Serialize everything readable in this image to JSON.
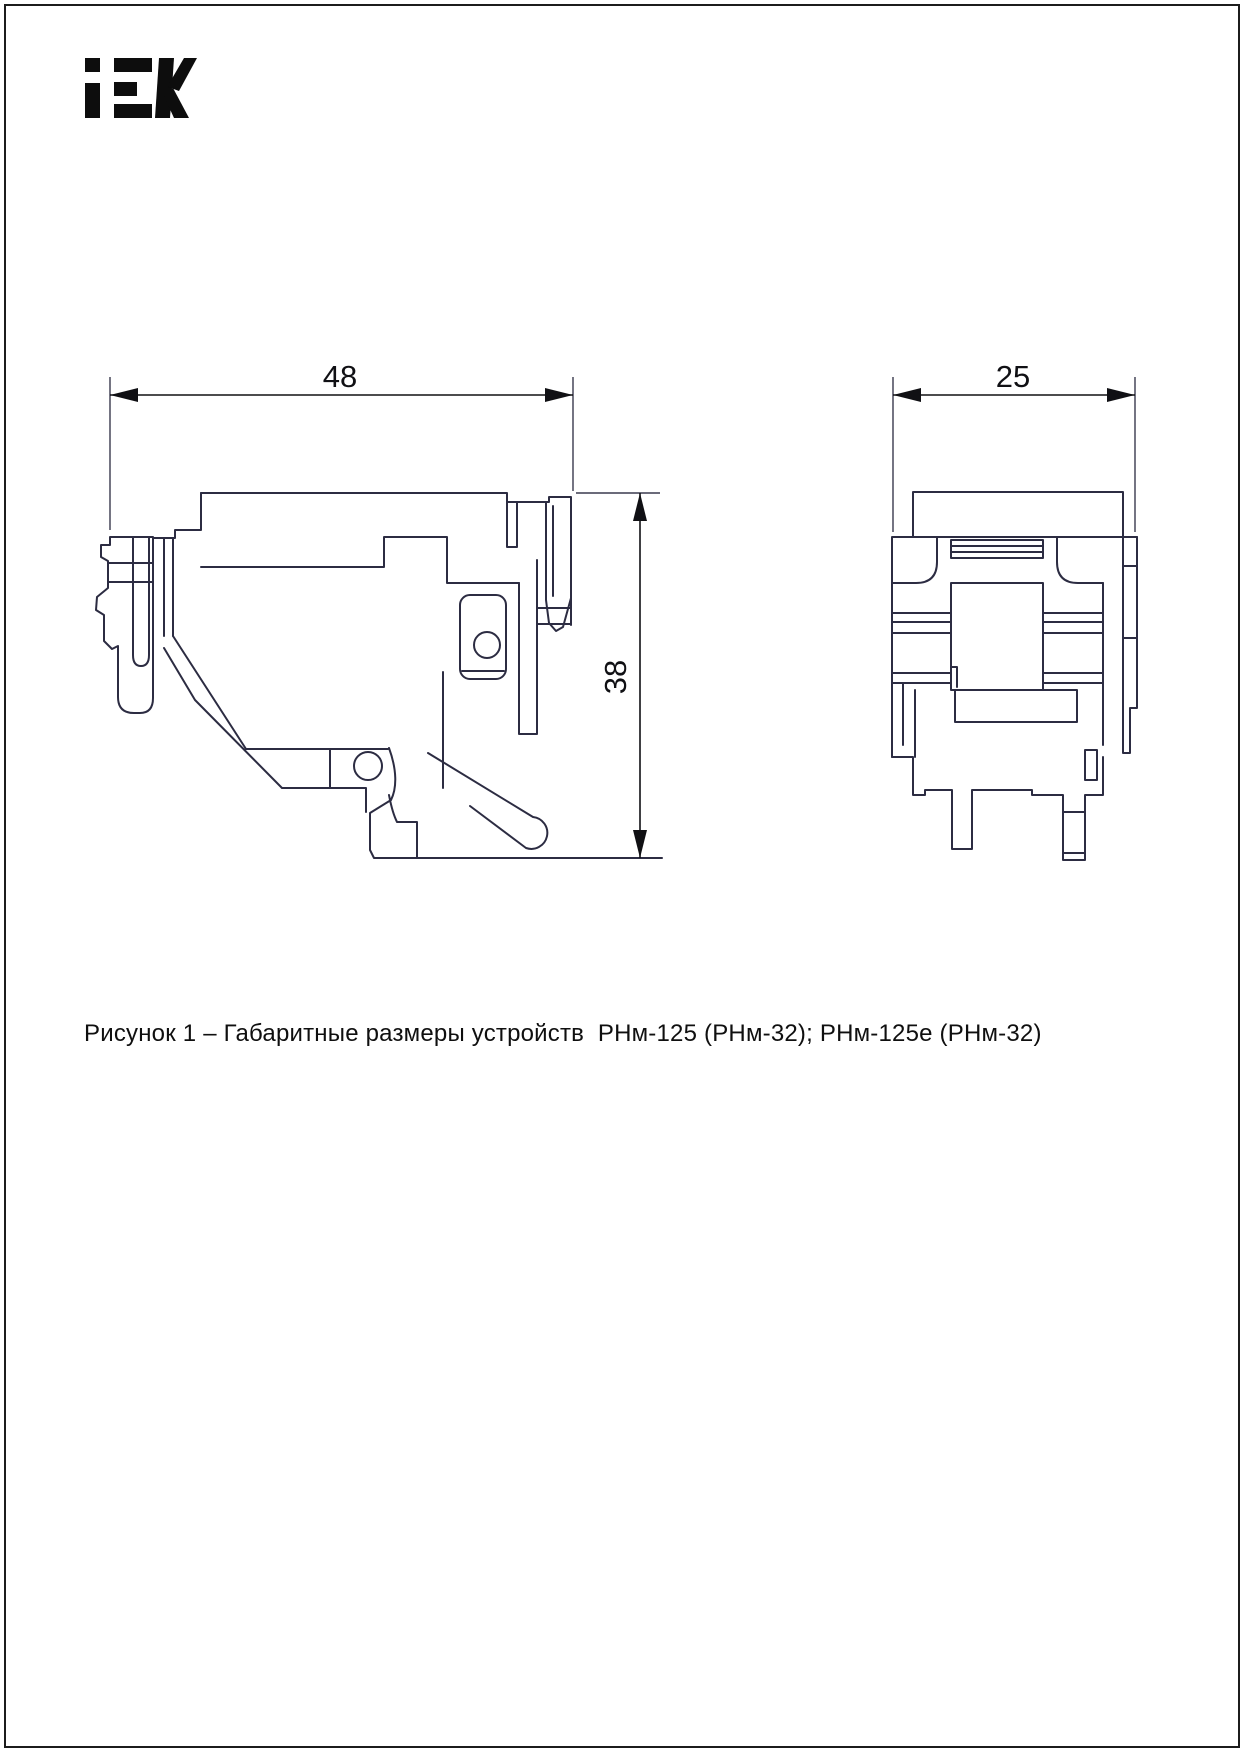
{
  "page": {
    "background": "#ffffff",
    "border_color": "#1c1c1c"
  },
  "logo": {
    "label": "IEK",
    "color": "#0d0d0d"
  },
  "drawing": {
    "line_color": "#2c2c42",
    "ext_line_color": "#3a3a4e",
    "dim_color": "#101014",
    "views": {
      "side_view": {
        "name": "side view of device",
        "width_dim": "48",
        "height_dim": "38"
      },
      "front_view": {
        "name": "front view of device",
        "depth_dim": "25"
      }
    }
  },
  "caption": {
    "text": "Рисунок 1 – Габаритные размеры устройств  РНм-125 (РНм-32); РНм-125е (РНм-32)"
  }
}
